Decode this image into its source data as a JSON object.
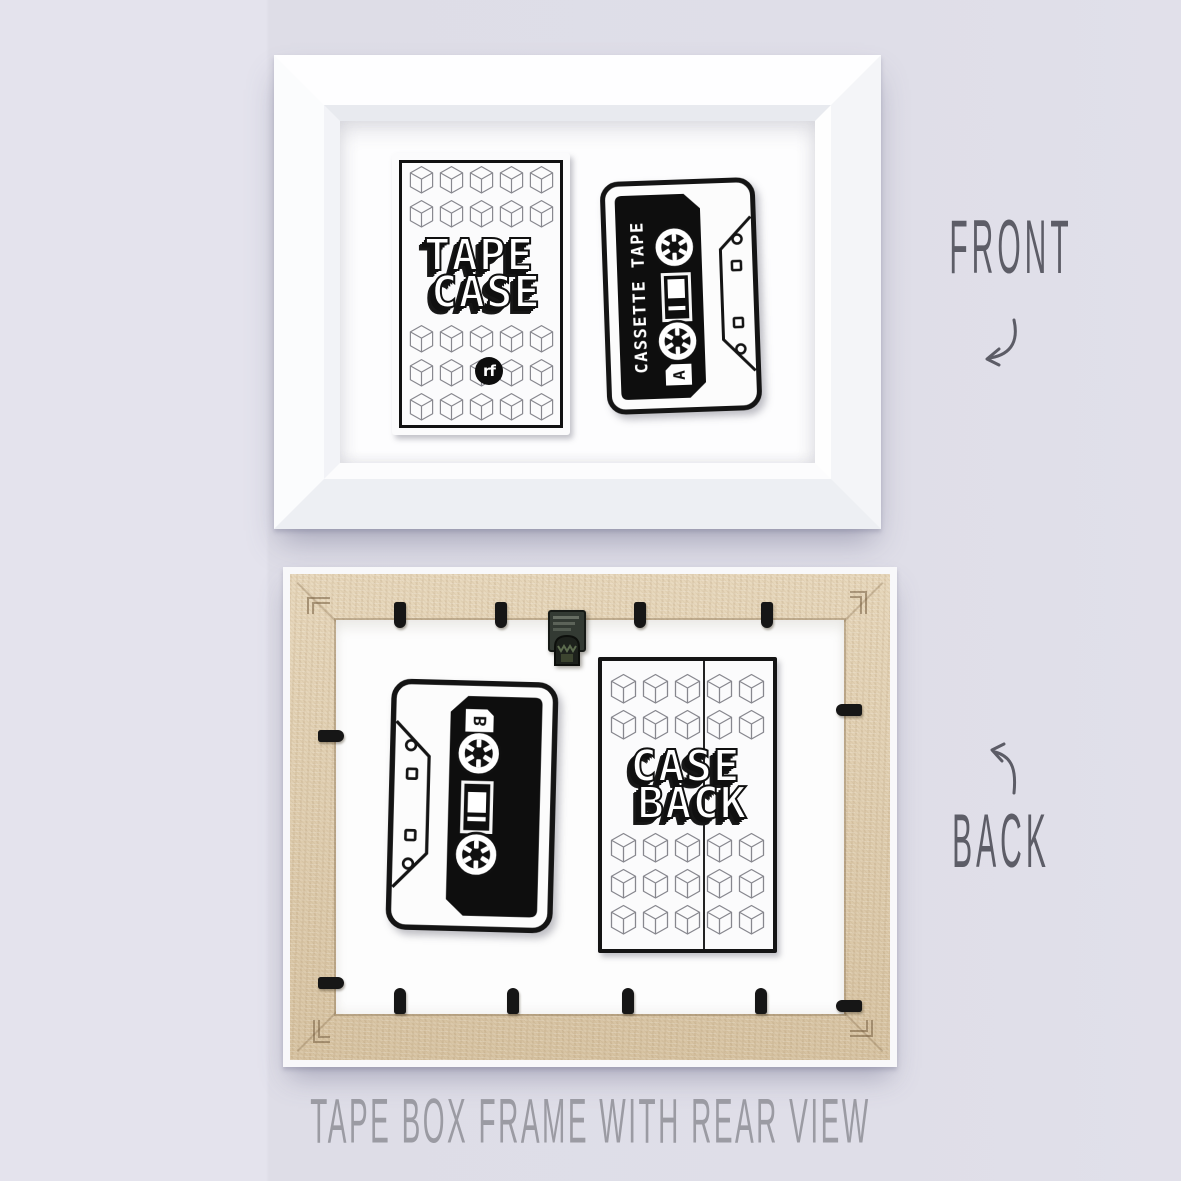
{
  "caption": "TAPE BOX FRAME WITH REAR VIEW",
  "annotations": {
    "front": "FRONT",
    "back": "BACK"
  },
  "front_frame": {
    "card": {
      "title_line1": "TAPE",
      "title_line2": "CASE",
      "logo_text": "rf",
      "cubes": {
        "cols": 5,
        "top_rows": 2,
        "bottom_rows": 3
      }
    },
    "cassette": {
      "label_text": "CASSETTE TAPE",
      "side_letter": "A"
    }
  },
  "back_frame": {
    "card": {
      "title_line1": "CASE",
      "title_line2": "BACK",
      "cubes": {
        "cols": 5,
        "top_rows": 2,
        "bottom_rows": 3
      }
    },
    "cassette": {
      "side_letter": "B"
    }
  },
  "colors": {
    "background": "#dfdee8",
    "frame_front": "#ffffff",
    "frame_back_wood": "#ddcaab",
    "clips": "#161616",
    "artwork_ink": "#111111",
    "annotation_text": "#5d5d67",
    "caption_text": "#9b9ba3"
  }
}
